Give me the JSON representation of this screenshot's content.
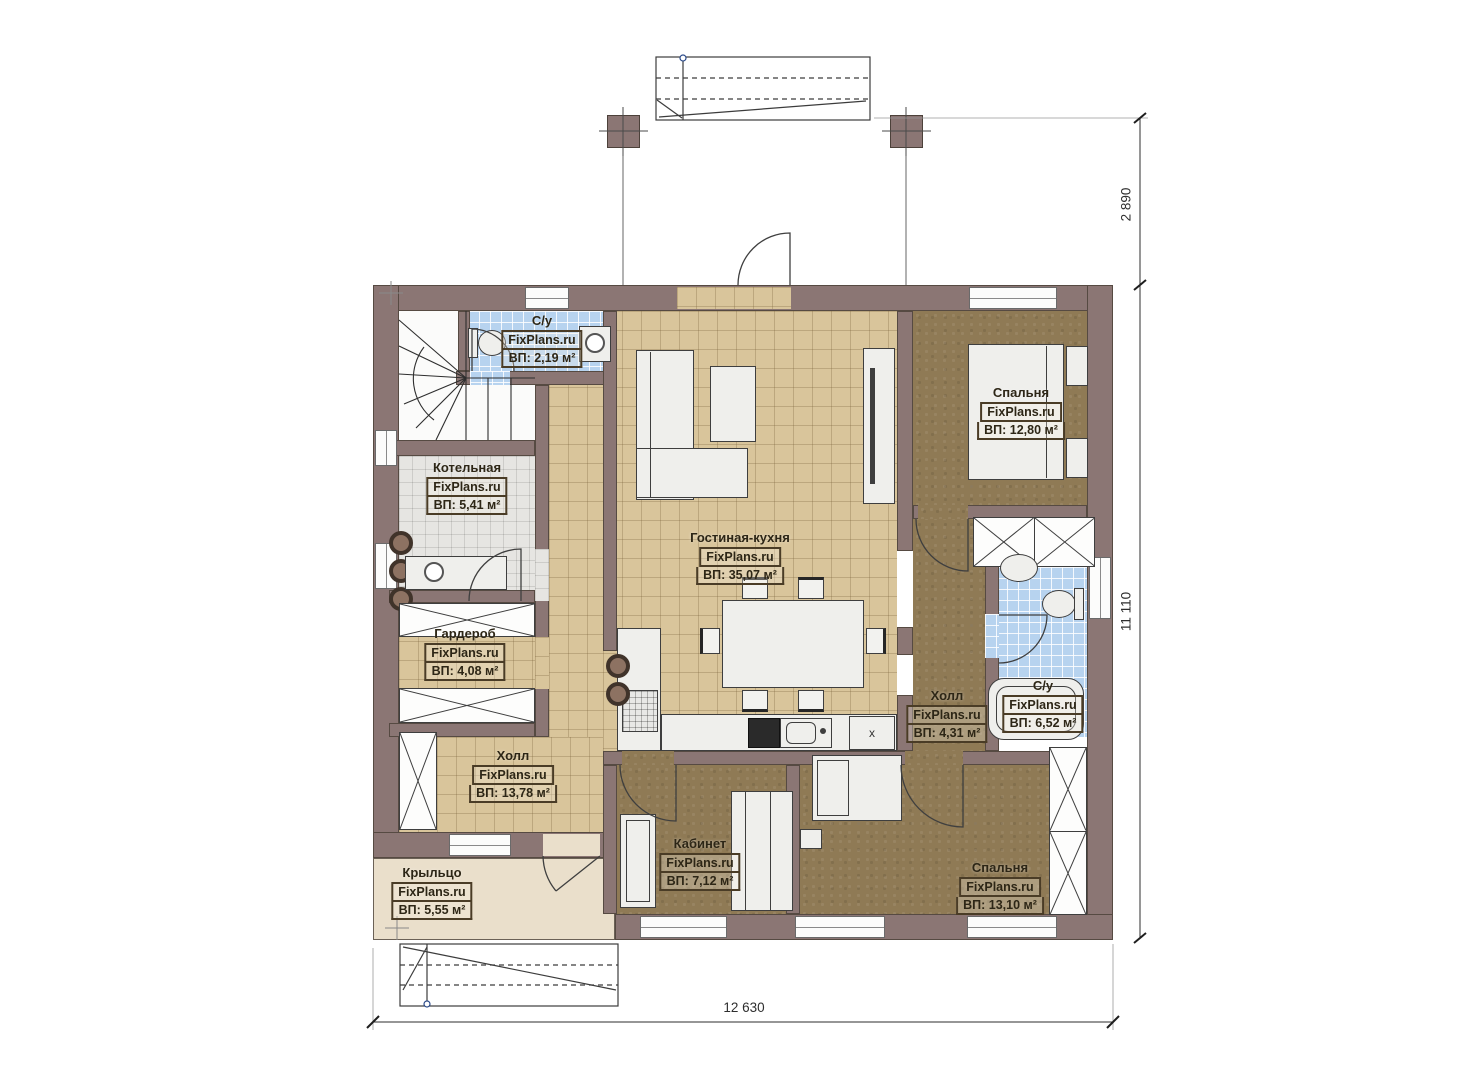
{
  "brand": "FixPlans.ru",
  "rooms": [
    {
      "key": "su_top",
      "name": "С/у",
      "area": "ВП: 2,19 м²"
    },
    {
      "key": "kotelnaya",
      "name": "Котельная",
      "area": "ВП: 5,41 м²"
    },
    {
      "key": "garderob",
      "name": "Гардероб",
      "area": "ВП: 4,08 м²"
    },
    {
      "key": "hall_left",
      "name": "Холл",
      "area": "ВП: 13,78 м²"
    },
    {
      "key": "kryltso",
      "name": "Крыльцо",
      "area": "ВП: 5,55 м²"
    },
    {
      "key": "living_kitchen",
      "name": "Гостиная-кухня",
      "area": "ВП: 35,07 м²"
    },
    {
      "key": "bedroom_top",
      "name": "Спальня",
      "area": "ВП: 12,80 м²"
    },
    {
      "key": "hall_right",
      "name": "Холл",
      "area": "ВП: 4,31 м²"
    },
    {
      "key": "su_right",
      "name": "С/у",
      "area": "ВП: 6,52 м²"
    },
    {
      "key": "kabinet",
      "name": "Кабинет",
      "area": "ВП: 7,12 м²"
    },
    {
      "key": "bedroom_bottom",
      "name": "Спальня",
      "area": "ВП: 13,10 м²"
    }
  ],
  "dimensions": {
    "terrace_height": "2 890",
    "house_height": "11 110",
    "house_width": "12 630"
  },
  "kitchen_marker": "x",
  "colors": {
    "wall": "#8b7674",
    "floor_tile": "#d9c59b",
    "floor_wood": "#8f7a55",
    "floor_bath": "#b7d3ef",
    "floor_boiler": "#e6e5e2",
    "floor_porch": "#eadfcb"
  }
}
